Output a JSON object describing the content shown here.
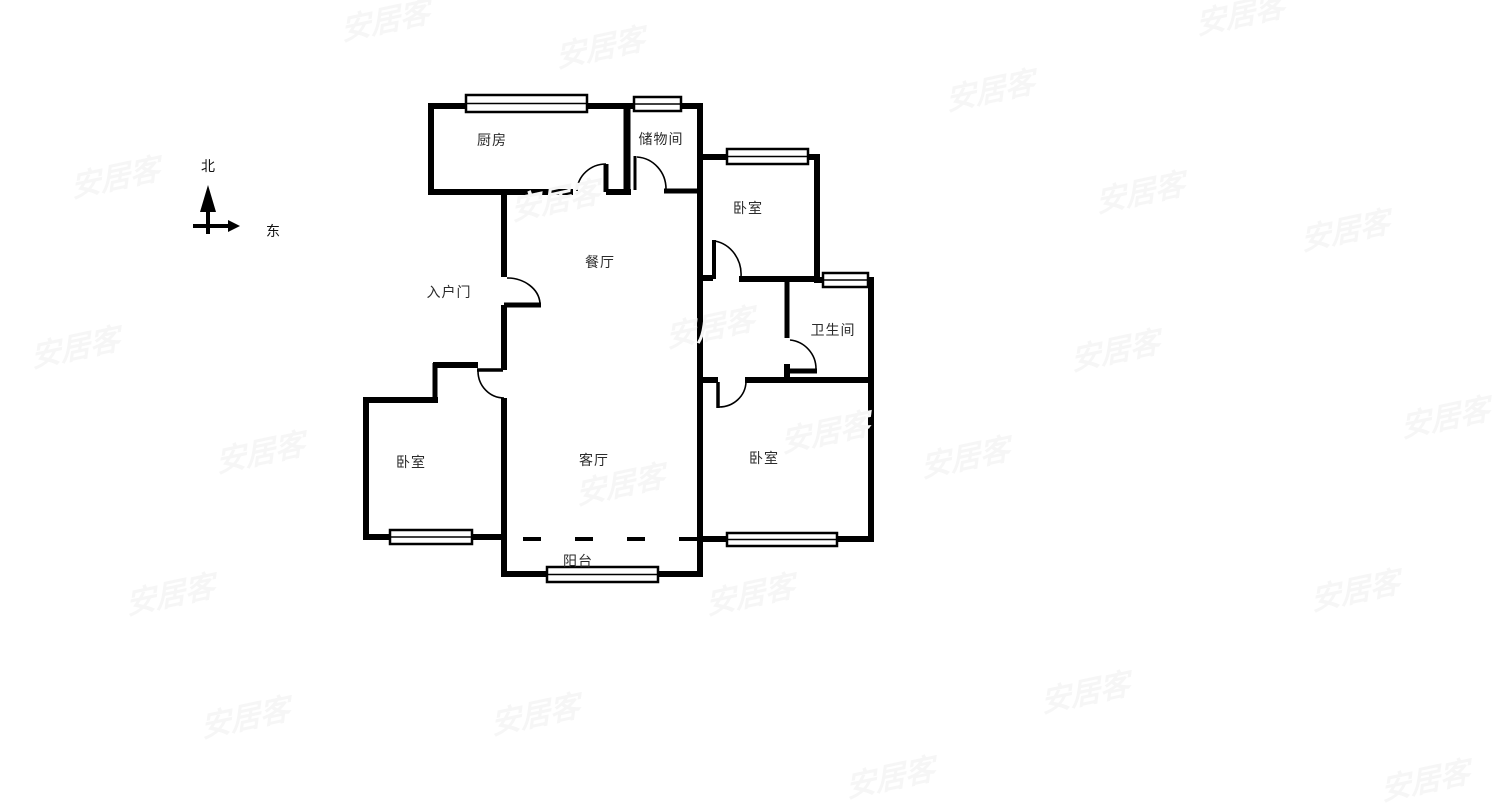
{
  "compass": {
    "north_label": "北",
    "east_label": "东"
  },
  "rooms": {
    "kitchen": {
      "label": "厨房"
    },
    "storage": {
      "label": "储物间"
    },
    "bedroom_top_right": {
      "label": "卧室"
    },
    "dining": {
      "label": "餐厅"
    },
    "entry": {
      "label": "入户门"
    },
    "bathroom": {
      "label": "卫生间"
    },
    "bedroom_left": {
      "label": "卧室"
    },
    "living": {
      "label": "客厅"
    },
    "bedroom_bottom_right": {
      "label": "卧室"
    },
    "balcony": {
      "label": "阳台"
    }
  },
  "watermark": {
    "text": "安居客",
    "color": "#f6f6f6",
    "positions": [
      [
        385,
        18
      ],
      [
        600,
        45
      ],
      [
        1240,
        12
      ],
      [
        990,
        88
      ],
      [
        115,
        175
      ],
      [
        555,
        198
      ],
      [
        1140,
        190
      ],
      [
        1345,
        228
      ],
      [
        75,
        345
      ],
      [
        710,
        325
      ],
      [
        1115,
        348
      ],
      [
        260,
        450
      ],
      [
        825,
        430
      ],
      [
        1445,
        415
      ],
      [
        965,
        455
      ],
      [
        620,
        482
      ],
      [
        170,
        592
      ],
      [
        750,
        592
      ],
      [
        1355,
        588
      ],
      [
        245,
        715
      ],
      [
        535,
        712
      ],
      [
        1085,
        690
      ],
      [
        890,
        775
      ],
      [
        1425,
        778
      ]
    ]
  },
  "colors": {
    "wall": "#000000",
    "label_text": "#2b2b2b",
    "background": "#ffffff"
  }
}
